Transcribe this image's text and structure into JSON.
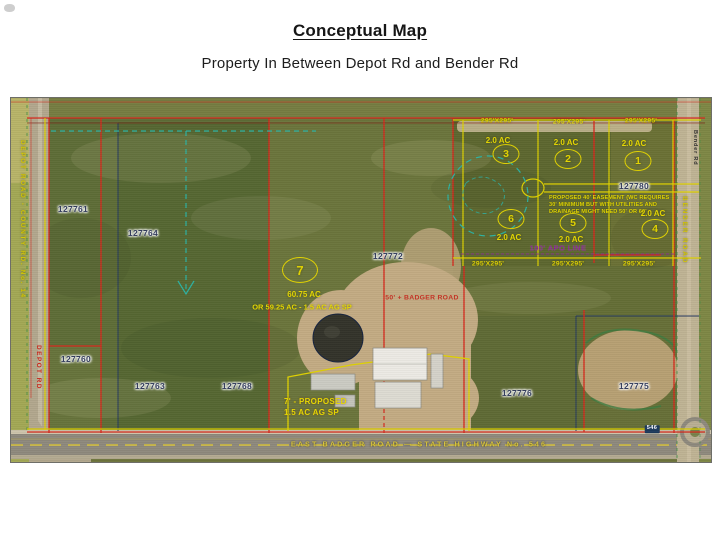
{
  "doc": {
    "title": "Conceptual Map",
    "subtitle": "Property In Between Depot Rd and Bender Rd"
  },
  "map": {
    "parcel_numbers": {
      "a": "127761",
      "b": "127764",
      "c": "127760",
      "d": "127763",
      "e": "127768",
      "f": "127772",
      "g": "127776",
      "h": "127775",
      "i": "127780"
    },
    "lots": {
      "lot1": {
        "num": "1",
        "area": "2.0 AC"
      },
      "lot2": {
        "num": "2",
        "area": "2.0 AC"
      },
      "lot3": {
        "num": "3",
        "area": "2.0 AC"
      },
      "lot4": {
        "num": "4",
        "area": "2.0 AC"
      },
      "lot5": {
        "num": "5",
        "area": "2.0 AC"
      },
      "lot6": {
        "num": "6",
        "area": "2.0 AC"
      },
      "lot7": {
        "num": "7",
        "area": "60.75 AC",
        "area_alt": "OR 59.25 AC - 1.5 AC AG SP"
      }
    },
    "annotations": {
      "dim295": "295'X295'",
      "apo": "100' APO LINE",
      "easement1": "PROPOSED 40' EASEMENT (WC REQUIRES",
      "easement2": "30' MINIMUM BUT WITH UTILITIES AND",
      "easement3": "DRAINAGE MIGHT NEED 50' OR 60'",
      "proposed1": "7' - PROPOSED",
      "proposed2": "1.5 AC AG SP",
      "red_note": "50' + BADGER ROAD",
      "hwy_badge": "546"
    },
    "roads": {
      "east_badger": "EAST BADGER ROAD  —  STATE HIGHWAY No. 546",
      "depot_long": "DEPOT ROAD - COUNTY RD. No. 14",
      "depot_short": "DEPOT RD",
      "bender": "Bender Rd",
      "bender_long": "BENDER ROAD"
    },
    "colors": {
      "lot_yellow": "#e3d400",
      "boundary_red": "#d5281c",
      "apo_purple": "#8b2796",
      "teal": "#2cb2a2",
      "road_label_yellow": "#d9c53c",
      "parcel_number_navy": "#333d5d"
    }
  }
}
